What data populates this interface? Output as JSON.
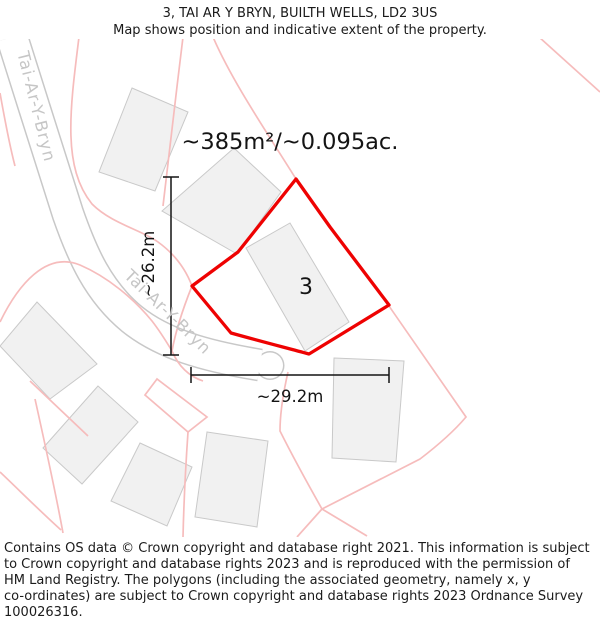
{
  "window": {
    "width": 600,
    "height": 625
  },
  "header": {
    "line1": "3, TAI AR Y BRYN, BUILTH WELLS, LD2 3US",
    "line2": "Map shows position and indicative extent of the property."
  },
  "map": {
    "area_label": "~385m²/~0.095ac.",
    "plot_number": "3",
    "vertical_dimension": "~26.2m",
    "horizontal_dimension": "~29.2m",
    "road_labels": [
      "Tai-Ar-Y-Bryn",
      "Tai-Ar-Y-Bryn"
    ],
    "colors": {
      "property_outline": "#ee0202",
      "parcel_lines": "#f6bcbc",
      "building_fill": "#f1f1f1",
      "building_stroke": "#c9c9c9",
      "road_casing": "#c8c8c8",
      "road_label_text": "#c6c6c6",
      "dimension_lines": "#141414"
    }
  },
  "footer": {
    "lines": [
      "Contains OS data © Crown copyright and database right 2021. This information is subject",
      "to Crown copyright and database rights 2023 and is reproduced with the permission of",
      "HM Land Registry. The polygons (including the associated geometry, namely x, y",
      "co-ordinates) are subject to Crown copyright and database rights 2023 Ordnance Survey",
      "100026316."
    ]
  }
}
